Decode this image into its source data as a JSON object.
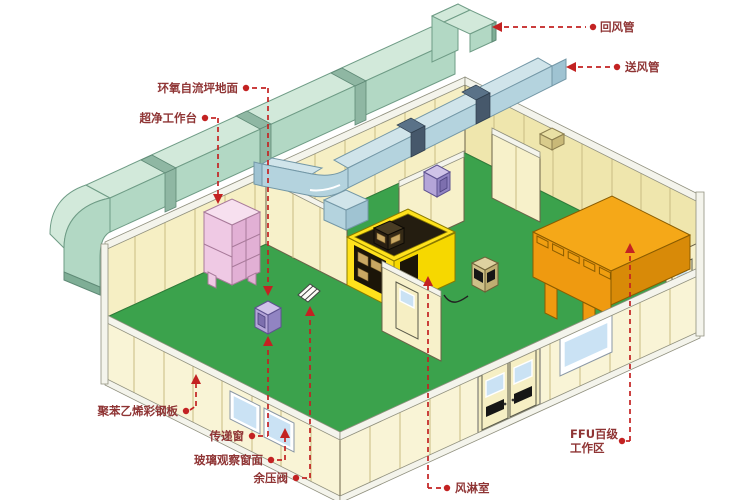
{
  "labels": {
    "return_air_duct": "回风管",
    "supply_air_duct": "送风管",
    "epoxy_floor": "环氧自流坪地面",
    "clean_bench": "超净工作台",
    "steel_panel": "聚苯乙烯彩钢板",
    "transfer_window": "传递窗",
    "glass_window": "玻璃观察窗面",
    "pressure_valve": "余压阀",
    "air_shower": "风淋室",
    "ffu_line1": "FFU百级",
    "ffu_line2": "工作区"
  },
  "colors": {
    "bg": "#ffffff",
    "accent": "#c32222",
    "label": "#8f3434",
    "floor": "#3ba24c",
    "wallBack": "#f6efc4",
    "wallBack2": "#efe6ad",
    "wallFront": "#f9f4d6",
    "wallInner": "#f7f1ca",
    "seam": "#c9bc82",
    "rail": "#f4f4ec",
    "ductGreenTop": "#d2e9da",
    "ductGreenSide": "#b2d8c4",
    "ductBlueTop": "#d0e4ea",
    "ductBlueSide": "#b4d3de",
    "window": "#cae2f4",
    "door": "#f6efc4",
    "yellow": "#ffe21c",
    "orange": "#f5a818",
    "pinkTop": "#f7e0ef"
  }
}
